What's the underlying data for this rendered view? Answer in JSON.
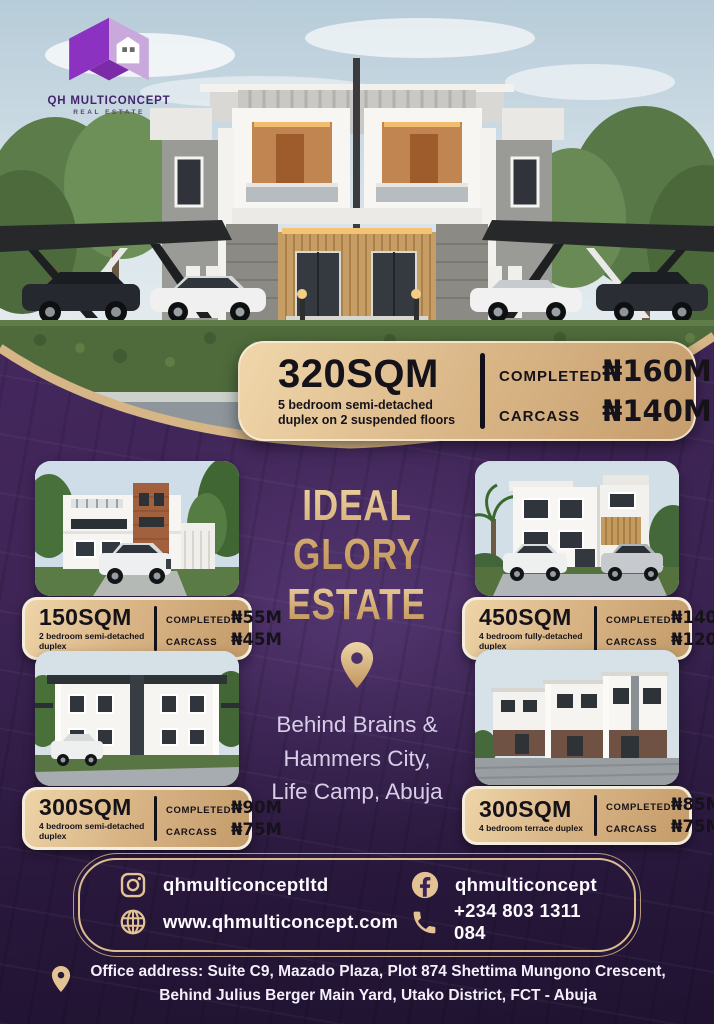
{
  "colors": {
    "purple_bg": "#3f2557",
    "gold": "#d6b586",
    "gold_deep": "#c29a6a",
    "text_on_gold": "#161219",
    "lavender_text": "#d8cee7"
  },
  "brand": {
    "name": "QH MULTICONCEPT",
    "tagline": "REAL ESTATE"
  },
  "labels": {
    "completed": "COMPLETED",
    "carcass": "CARCASS"
  },
  "hero_offer": {
    "size": "320SQM",
    "description": "5 bedroom semi-detached duplex on 2 suspended floors",
    "completed_price": "₦160M",
    "carcass_price": "₦140M"
  },
  "estate": {
    "title_line1": "IDEAL GLORY",
    "title_line2": "ESTATE",
    "location_lines": [
      "Behind  Brains &",
      "Hammers City,",
      "Life Camp, Abuja"
    ]
  },
  "listings": [
    {
      "size": "150SQM",
      "description": "2 bedroom semi-detached duplex",
      "completed_price": "₦55M",
      "carcass_price": "₦45M"
    },
    {
      "size": "450SQM",
      "description": "4 bedroom fully-detached duplex",
      "completed_price": "₦140M",
      "carcass_price": "₦120M"
    },
    {
      "size": "300SQM",
      "description": "4 bedroom semi-detached duplex",
      "completed_price": "₦90M",
      "carcass_price": "₦75M"
    },
    {
      "size": "300SQM",
      "description": "4 bedroom terrace duplex",
      "completed_price": "₦85M",
      "carcass_price": "₦75M"
    }
  ],
  "contact": {
    "instagram": "qhmulticonceptltd",
    "facebook": "qhmulticoncept",
    "website": "www.qhmulticoncept.com",
    "phone": "+234 803 1311 084"
  },
  "footer": {
    "address_line1": "Office address: Suite C9, Mazado Plaza, Plot 874 Shettima Mungono Crescent,",
    "address_line2": "Behind Julius Berger Main Yard, Utako District, FCT - Abuja"
  },
  "icons": {
    "logo": "house-cube-logo",
    "location": "location-pin",
    "instagram": "instagram-camera",
    "facebook": "facebook-f",
    "website": "globe",
    "phone": "phone-handset"
  }
}
